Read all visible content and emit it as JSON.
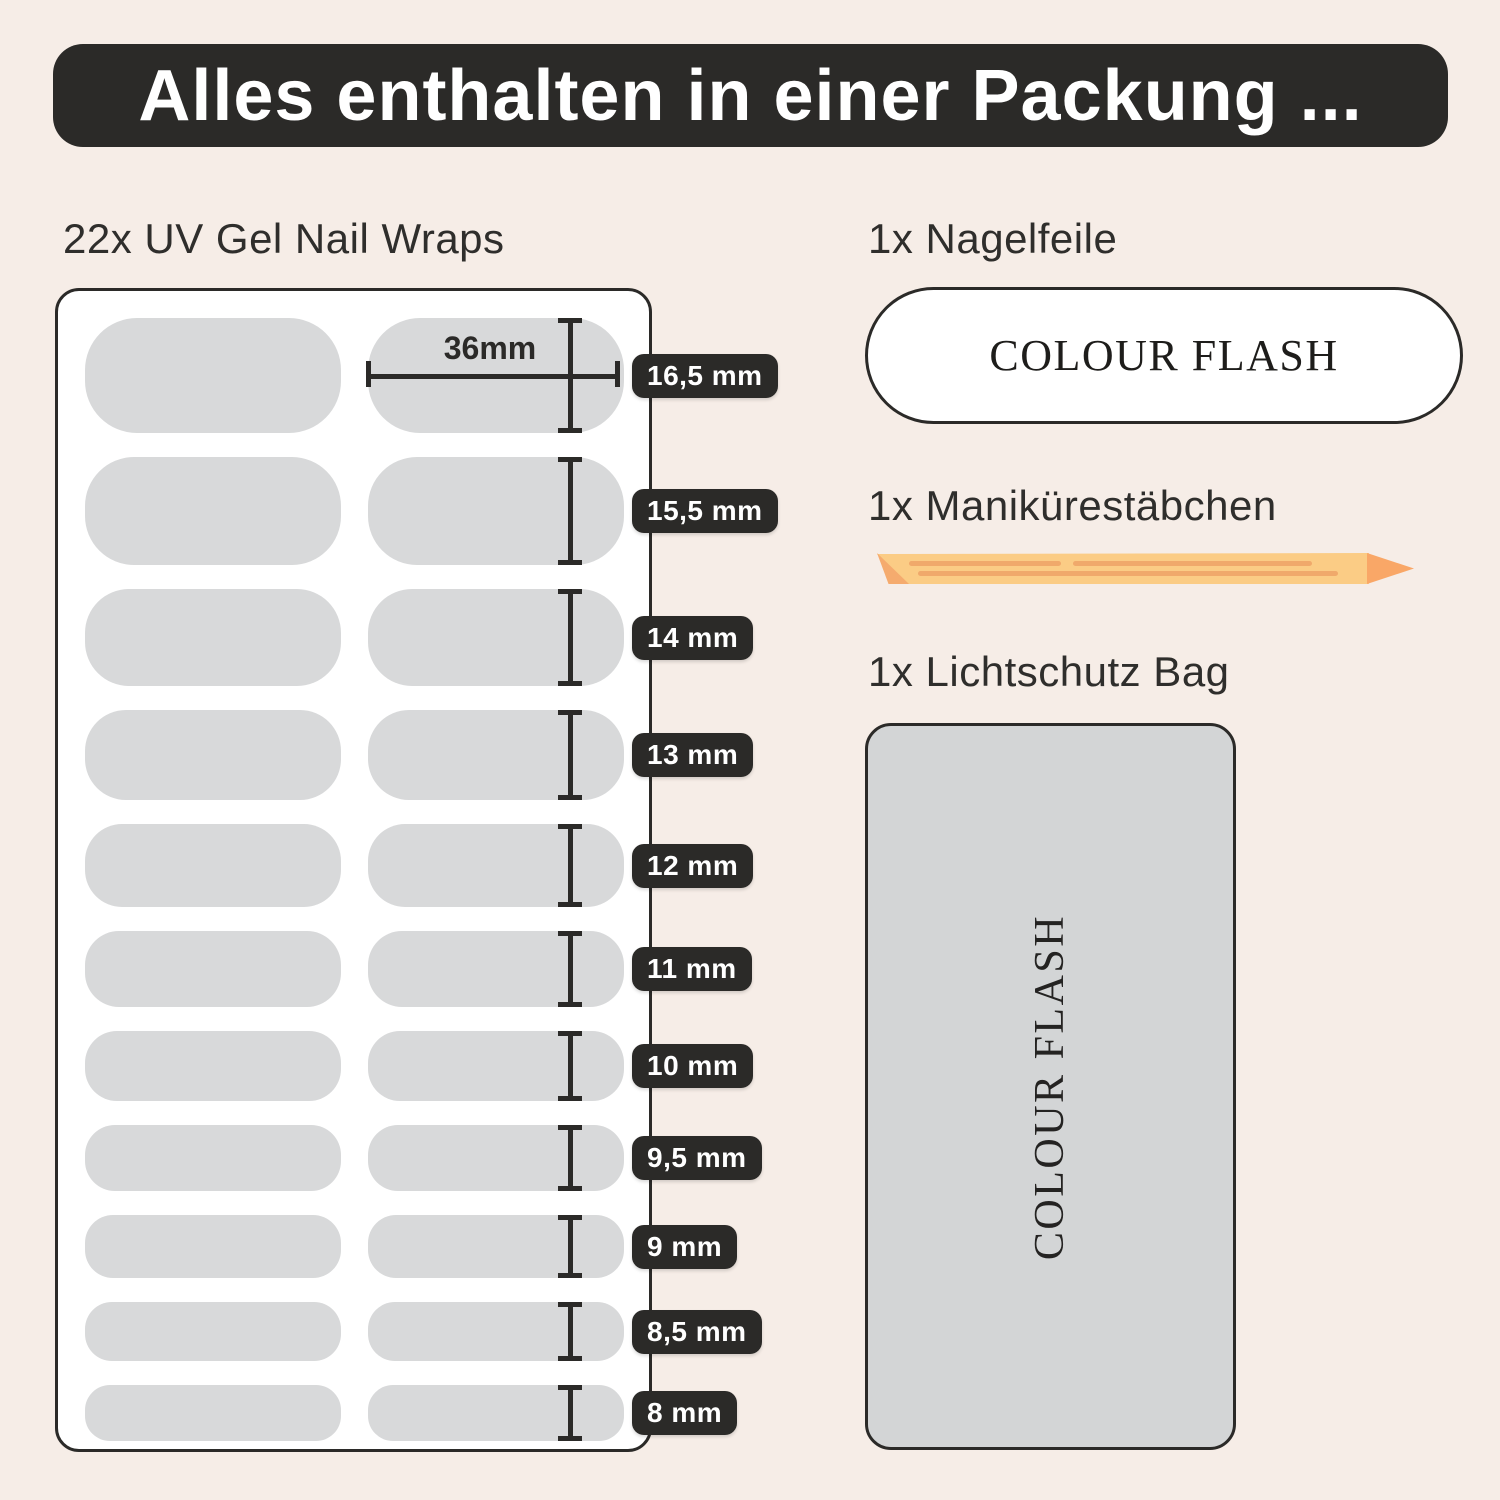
{
  "header": {
    "title": "Alles enthalten in einer Packung ..."
  },
  "nail_wraps": {
    "heading": "22x UV Gel Nail Wraps",
    "width_label": "36mm",
    "rows": [
      {
        "size_label": "16,5 mm",
        "mm": 16.5
      },
      {
        "size_label": "15,5 mm",
        "mm": 15.5
      },
      {
        "size_label": "14 mm",
        "mm": 14
      },
      {
        "size_label": "13 mm",
        "mm": 13
      },
      {
        "size_label": "12 mm",
        "mm": 12
      },
      {
        "size_label": "11 mm",
        "mm": 11
      },
      {
        "size_label": "10 mm",
        "mm": 10
      },
      {
        "size_label": "9,5 mm",
        "mm": 9.5
      },
      {
        "size_label": "9 mm",
        "mm": 9
      },
      {
        "size_label": "8,5 mm",
        "mm": 8.5
      },
      {
        "size_label": "8 mm",
        "mm": 8
      }
    ]
  },
  "nail_file": {
    "heading": "1x Nagelfeile",
    "brand": "COLOUR FLASH"
  },
  "manicure_stick": {
    "heading": "1x Manikürestäbchen"
  },
  "bag": {
    "heading": "1x Lichtschutz Bag",
    "brand": "COLOUR FLASH"
  },
  "colors": {
    "background": "#f6ede7",
    "dark": "#2b2a28",
    "wrap_gray": "#d8d9da",
    "bag_gray": "#d3d5d6",
    "stick_body": "#fbcc85",
    "stick_tip": "#f9a767",
    "stick_grain": "#f0a96b"
  }
}
